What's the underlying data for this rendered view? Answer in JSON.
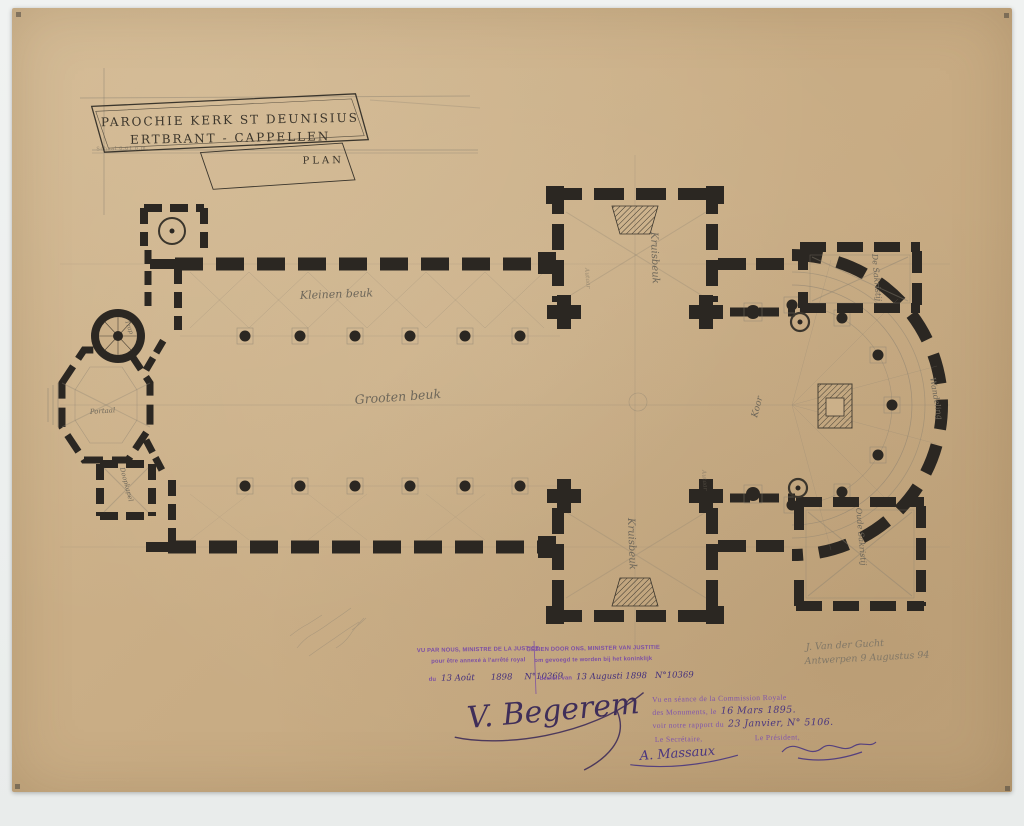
{
  "title_block": {
    "line1": "PAROCHIE KERK ST DEUNISIUS",
    "line2": "ERTBRANT - CAPPELLEN",
    "plan_label": "PLAN",
    "scale_note": "Schaal 0.01 p.m."
  },
  "plan_labels": {
    "aisle_top": "Kleinen beuk",
    "nave": "Grooten beuk",
    "transept_top": "Kruisbeuk",
    "transept_bottom": "Kruisbeuk",
    "choir": "Koor",
    "ambulatory": "Wandeling",
    "sacristy_top": "De Sakristij",
    "sacristy_bottom": "Oude Sakristij",
    "portal": "Portaal",
    "stair": "Trap",
    "baptistery": "Doopkapel",
    "altar_top": "Autaar",
    "altar_bottom": "Autaar"
  },
  "stamps": {
    "french": {
      "line1": "VU PAR NOUS, MINISTRE DE LA JUSTICE",
      "line2": "pour être annexé à l'arrêté royal",
      "line3_prefix": "du",
      "handwritten_date": "13 Août",
      "handwritten_year": "1898",
      "handwritten_number": "N°10369"
    },
    "dutch": {
      "line1": "GEZIEN DOOR ONS, MINISTER VAN JUSTITIE",
      "line2": "om gevoegd te worden bij het koninklijk",
      "line3_prefix": "besluit van",
      "handwritten_date": "13 Augusti 1898",
      "handwritten_number": "N°10369"
    },
    "commission": {
      "line1": "Vu en séance de la Commission Royale",
      "line2_prefix": "des Monuments, le",
      "line2_handwritten": "16 Mars 1895.",
      "line3_prefix": "voir notre rapport du",
      "line3_handwritten": "23 Janvier, N° 5106.",
      "secretary_label": "Le Secrétaire,",
      "president_label": "Le Président,"
    }
  },
  "signatures": {
    "minister": "V. Begerem",
    "secretary": "A. Massaux"
  },
  "annotations": {
    "architect_line1": "J. Van der Gucht",
    "architect_line2": "Antwerpen 9 Augustus 94"
  },
  "colors": {
    "paper": "#c9ad85",
    "ink": "#2b2722",
    "pencil": "#8a8172",
    "stamp_purple": "#7c4fa5",
    "stamp_ink": "#44307c",
    "background": "#eef0ee"
  }
}
